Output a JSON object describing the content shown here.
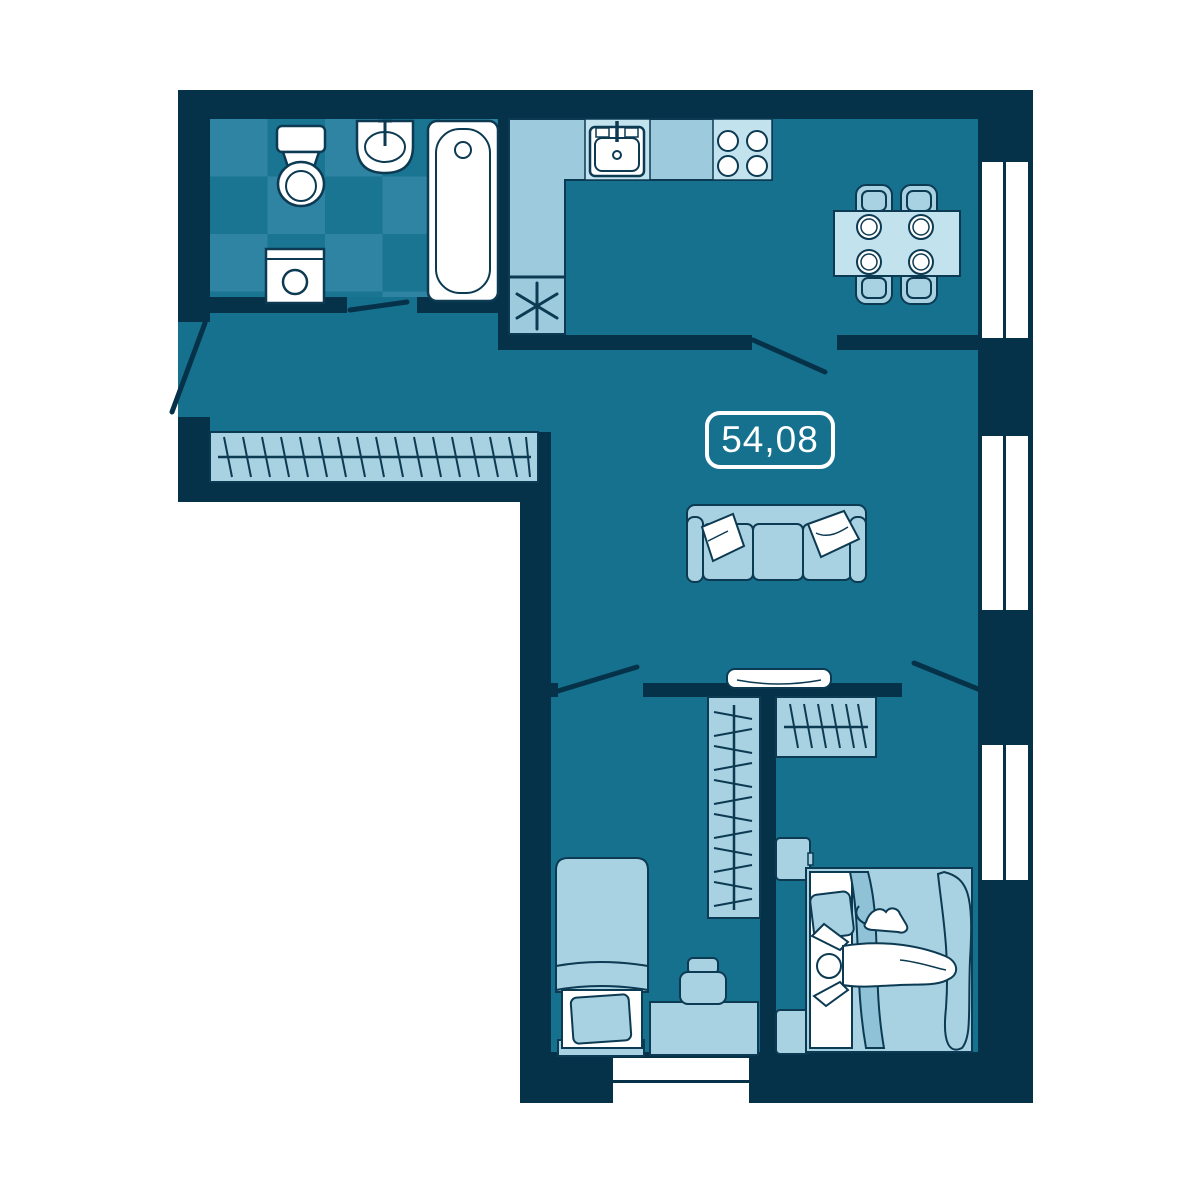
{
  "plan": {
    "area_label": "54,08"
  },
  "colors": {
    "white": "#ffffff",
    "wall": "#053249",
    "floor": "#16718f",
    "tile_base": "#1a7592",
    "tile_light": "#2f84a3",
    "furniture": "#a8d1e1",
    "furniture_light": "#c2e3ee",
    "counter": "#9dcbdd",
    "blanket_shade": "#8fc2d6",
    "outline": "#0c3a52"
  }
}
